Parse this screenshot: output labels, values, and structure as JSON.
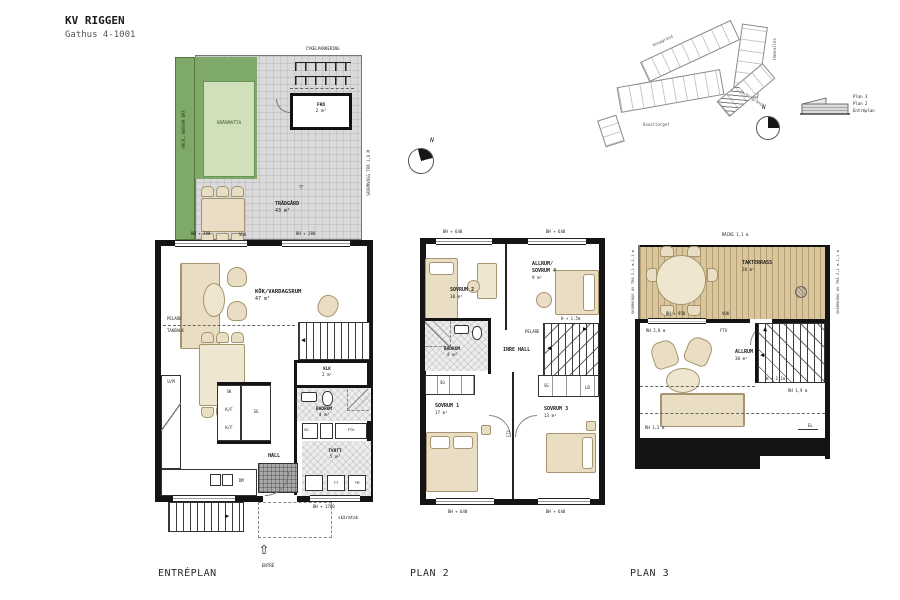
{
  "title": {
    "project": "KV RIGGEN",
    "unit": "Gathus 4-1001"
  },
  "colors": {
    "wall": "#141414",
    "lawn_light": "#cfe0ba",
    "lawn_dark": "#7fa968",
    "paving": "#dadada",
    "deck_wood": "#d9c69d",
    "furniture": "#e9dec3"
  },
  "site": {
    "streets": {
      "top": "Knopgränd",
      "right": "Hamnallén",
      "diagonal": "Tackelgränd",
      "square": "Kanaltorget"
    },
    "north": "N",
    "section": {
      "plan3": "Plan 3",
      "plan2": "Plan 2",
      "entreplan": "Entréplan"
    }
  },
  "entreplan": {
    "plan_label": "ENTRÉPLAN",
    "north": "N",
    "garden": {
      "cykelparkering": "CYKELPARKERING",
      "frd": "FRD",
      "frd_area": "2 m²",
      "grasmatta": "GRÄSMATTA",
      "tradgard": "TRÄDGÅRD",
      "tradgard_area": "43 m²",
      "hack": "HÄCK, ANSVAR BRF",
      "skarmvagg": "SKÄRMVÄGG TRÄ 1,8 M",
      "bh_280": "BH + 280",
      "vuk": "VUK"
    },
    "rooms": {
      "kok_vardagsrum": "KÖK/VARDAGSRUM",
      "kok_vardagsrum_area": "47 m²",
      "klk": "KLK",
      "klk_area": "2 m²",
      "badrum": "BADRUM",
      "badrum_area": "4 m²",
      "hall": "HALL",
      "tvatt": "TVÄTT",
      "tvatt_area": "5 m²"
    },
    "annotations": {
      "pelare": "PELARE",
      "takbalk": "TAKBALK",
      "um": "U/M",
      "sk": "SK",
      "kf": "K/F",
      "sg": "SG",
      "dm": "DM",
      "ftx": "FTX",
      "tt": "TT",
      "tm": "TM",
      "bh_1700": "BH + 1700",
      "skarmtak": "skärmtak",
      "entre": "ENTRÉ"
    }
  },
  "plan2": {
    "plan_label": "PLAN 2",
    "rooms": {
      "sovrum2": "SOVRUM 2",
      "sovrum2_area": "10 m²",
      "allrum_sovrum4_line1": "ALLRUM/",
      "allrum_sovrum4_line2": "SOVRUM 4",
      "allrum_sovrum4_area": "9 m²",
      "badrum": "BADRUM",
      "badrum_area": "4 m²",
      "inre_hall": "INRE HALL",
      "sovrum1": "SOVRUM 1",
      "sovrum1_area": "17 m²",
      "sovrum3": "SOVRUM 3",
      "sovrum3_area": "13 m²"
    },
    "annotations": {
      "bh_640": "BH + 640",
      "pelare": "PELARE",
      "h_15": "H + 1,5m",
      "sg": "SG",
      "lb": "LB",
      "ftx": "FTX"
    }
  },
  "plan3": {
    "plan_label": "PLAN 3",
    "rooms": {
      "takterrass": "TAKTERRASS",
      "takterrass_area": "20 m²",
      "allrum": "ALLRUM",
      "allrum_area": "30 m²"
    },
    "annotations": {
      "racke": "RÄCKE 1,1 m",
      "skarmvagg": "SKÄRMVÄGG AV TRÄ 2,1 m-1,1 m",
      "bh_950": "BH + 950",
      "vuk": "VUK",
      "rh_28": "RH 2,8 m",
      "rh_19": "RH 1,9 m",
      "rh_12": "RH 1,2 m",
      "h_11": "H + 1,1m",
      "ftx": "FTX",
      "el": "EL"
    }
  }
}
